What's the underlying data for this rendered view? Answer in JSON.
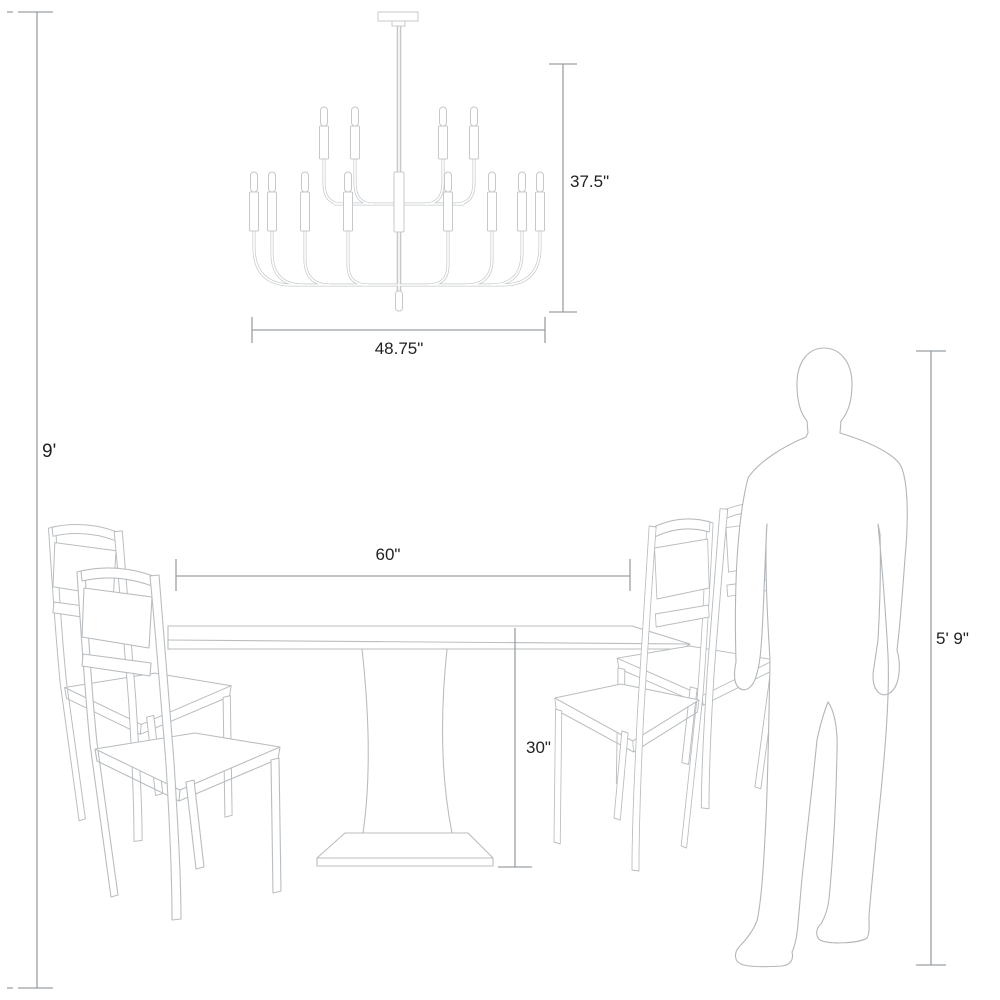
{
  "diagram": {
    "labels": {
      "ceiling_height": "9'",
      "chandelier_height": "37.5\"",
      "chandelier_width": "48.75\"",
      "table_width": "60\"",
      "table_height": "30\"",
      "person_height": "5' 9\""
    },
    "objects": {
      "chandelier": "two-tier candelabra chandelier",
      "table": "rectangular pedestal dining table",
      "chairs": "four ladder-back dining chairs",
      "person": "standing human silhouette for scale"
    },
    "colors": {
      "background": "#ffffff",
      "furniture_line": "#b9bdc0",
      "chandelier_line": "#c5c9cc",
      "dimension_line": "#9aa0a4",
      "text": "#222222"
    }
  }
}
